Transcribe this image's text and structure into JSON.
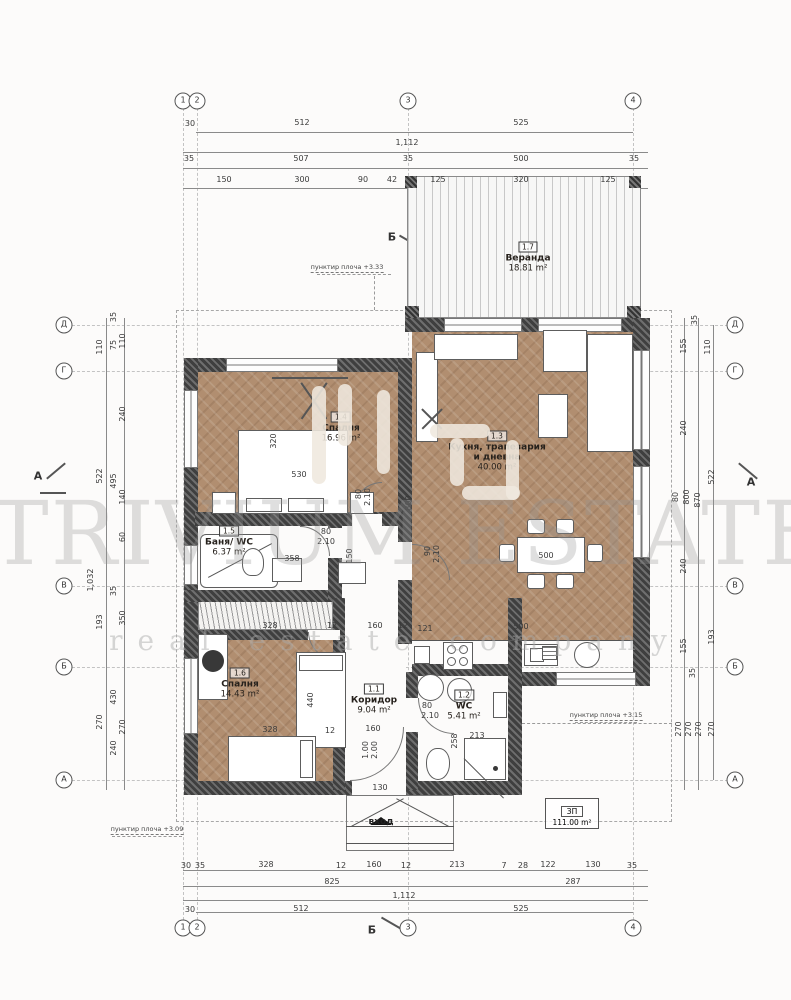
{
  "watermark": {
    "line1": "TRIVIUM ESTATE",
    "line2": "real estate company"
  },
  "entry": {
    "label": "вход"
  },
  "zp": {
    "label": "ЗП",
    "area": "111.00 m²"
  },
  "colors": {
    "floor_brown": "#b18e70",
    "wall_dark": "#4b4b4b",
    "line": "#8a8a8a"
  },
  "rooms": [
    {
      "id": "1.7",
      "name": "Веранда",
      "area": "18.81 m²",
      "x": 528,
      "y": 254
    },
    {
      "id": "1.3",
      "name": "Кухня, трапезария",
      "name2": "и дневна",
      "area": "40.00 m²",
      "x": 497,
      "y": 448
    },
    {
      "id": "1.4",
      "name": "Спалня",
      "area": "16.96 m²",
      "x": 341,
      "y": 424
    },
    {
      "id": "1.5",
      "name": "Баня/ WC",
      "area": "6.37 m²",
      "x": 229,
      "y": 538
    },
    {
      "id": "1.6",
      "name": "Спалня",
      "area": "14.43 m²",
      "x": 240,
      "y": 680
    },
    {
      "id": "1.1",
      "name": "Коридор",
      "area": "9.04 m²",
      "x": 374,
      "y": 696
    },
    {
      "id": "1.2",
      "name": "WC",
      "area": "5.41 m²",
      "x": 464,
      "y": 702
    }
  ],
  "bubbles": [
    {
      "t": "1",
      "x": 183,
      "y": 101
    },
    {
      "t": "2",
      "x": 197,
      "y": 101
    },
    {
      "t": "3",
      "x": 408,
      "y": 101
    },
    {
      "t": "4",
      "x": 633,
      "y": 101
    },
    {
      "t": "1",
      "x": 183,
      "y": 928
    },
    {
      "t": "2",
      "x": 197,
      "y": 928
    },
    {
      "t": "3",
      "x": 408,
      "y": 928
    },
    {
      "t": "4",
      "x": 633,
      "y": 928
    },
    {
      "t": "Д",
      "x": 64,
      "y": 325
    },
    {
      "t": "Г",
      "x": 64,
      "y": 371
    },
    {
      "t": "В",
      "x": 64,
      "y": 586
    },
    {
      "t": "Б",
      "x": 64,
      "y": 667
    },
    {
      "t": "А",
      "x": 64,
      "y": 780
    },
    {
      "t": "Д",
      "x": 735,
      "y": 325
    },
    {
      "t": "Г",
      "x": 735,
      "y": 371
    },
    {
      "t": "В",
      "x": 735,
      "y": 586
    },
    {
      "t": "Б",
      "x": 735,
      "y": 667
    },
    {
      "t": "А",
      "x": 735,
      "y": 780
    }
  ],
  "markers": [
    {
      "t": "Б",
      "x": 392,
      "y": 237
    },
    {
      "t": "А",
      "x": 38,
      "y": 476
    },
    {
      "t": "А",
      "x": 751,
      "y": 482
    },
    {
      "t": "Б",
      "x": 372,
      "y": 930
    }
  ],
  "annotations": [
    {
      "t": "пунктир плоча +3.33",
      "x": 347,
      "y": 268
    },
    {
      "t": "пунктир плоча +3.15",
      "x": 606,
      "y": 716
    },
    {
      "t": "пунктир плоча +3.09",
      "x": 147,
      "y": 830
    }
  ],
  "dimensions": [
    {
      "t": "30",
      "x": 190,
      "y": 124
    },
    {
      "t": "512",
      "x": 302,
      "y": 123
    },
    {
      "t": "525",
      "x": 521,
      "y": 123
    },
    {
      "t": "1,112",
      "x": 407,
      "y": 143
    },
    {
      "t": "35",
      "x": 189,
      "y": 159
    },
    {
      "t": "507",
      "x": 301,
      "y": 159
    },
    {
      "t": "35",
      "x": 408,
      "y": 159
    },
    {
      "t": "500",
      "x": 521,
      "y": 159
    },
    {
      "t": "35",
      "x": 634,
      "y": 159
    },
    {
      "t": "150",
      "x": 224,
      "y": 180
    },
    {
      "t": "300",
      "x": 302,
      "y": 180
    },
    {
      "t": "90",
      "x": 363,
      "y": 180
    },
    {
      "t": "42",
      "x": 392,
      "y": 180
    },
    {
      "t": "125",
      "x": 438,
      "y": 180
    },
    {
      "t": "320",
      "x": 521,
      "y": 180
    },
    {
      "t": "125",
      "x": 608,
      "y": 180
    },
    {
      "t": "30",
      "x": 186,
      "y": 866
    },
    {
      "t": "35",
      "x": 200,
      "y": 866
    },
    {
      "t": "328",
      "x": 266,
      "y": 865
    },
    {
      "t": "12",
      "x": 341,
      "y": 866
    },
    {
      "t": "160",
      "x": 374,
      "y": 865
    },
    {
      "t": "12",
      "x": 406,
      "y": 866
    },
    {
      "t": "213",
      "x": 457,
      "y": 865
    },
    {
      "t": "7",
      "x": 504,
      "y": 866
    },
    {
      "t": "28",
      "x": 523,
      "y": 866
    },
    {
      "t": "122",
      "x": 548,
      "y": 865
    },
    {
      "t": "130",
      "x": 593,
      "y": 865
    },
    {
      "t": "35",
      "x": 632,
      "y": 866
    },
    {
      "t": "825",
      "x": 332,
      "y": 882
    },
    {
      "t": "287",
      "x": 573,
      "y": 882
    },
    {
      "t": "1,112",
      "x": 404,
      "y": 896
    },
    {
      "t": "30",
      "x": 190,
      "y": 910
    },
    {
      "t": "512",
      "x": 301,
      "y": 909
    },
    {
      "t": "525",
      "x": 521,
      "y": 909
    },
    {
      "t": "110",
      "x": 100,
      "y": 347,
      "r": -90
    },
    {
      "t": "522",
      "x": 100,
      "y": 476,
      "r": -90
    },
    {
      "t": "193",
      "x": 100,
      "y": 622,
      "r": -90
    },
    {
      "t": "270",
      "x": 100,
      "y": 722,
      "r": -90
    },
    {
      "t": "35",
      "x": 114,
      "y": 317,
      "r": -90
    },
    {
      "t": "110",
      "x": 123,
      "y": 341,
      "r": -90
    },
    {
      "t": "75",
      "x": 114,
      "y": 345,
      "r": -90
    },
    {
      "t": "240",
      "x": 123,
      "y": 414,
      "r": -90
    },
    {
      "t": "495",
      "x": 114,
      "y": 481,
      "r": -90
    },
    {
      "t": "140",
      "x": 123,
      "y": 497,
      "r": -90
    },
    {
      "t": "60",
      "x": 123,
      "y": 537,
      "r": -90
    },
    {
      "t": "1,032",
      "x": 91,
      "y": 580,
      "r": -90
    },
    {
      "t": "35",
      "x": 114,
      "y": 591,
      "r": -90
    },
    {
      "t": "350",
      "x": 123,
      "y": 618,
      "r": -90
    },
    {
      "t": "430",
      "x": 114,
      "y": 697,
      "r": -90
    },
    {
      "t": "270",
      "x": 123,
      "y": 727,
      "r": -90
    },
    {
      "t": "240",
      "x": 114,
      "y": 748,
      "r": -90
    },
    {
      "t": "35",
      "x": 695,
      "y": 320,
      "r": -90
    },
    {
      "t": "155",
      "x": 684,
      "y": 346,
      "r": -90
    },
    {
      "t": "110",
      "x": 708,
      "y": 347,
      "r": -90
    },
    {
      "t": "240",
      "x": 684,
      "y": 428,
      "r": -90
    },
    {
      "t": "80",
      "x": 676,
      "y": 497,
      "r": -90
    },
    {
      "t": "800",
      "x": 687,
      "y": 497,
      "r": -90
    },
    {
      "t": "870",
      "x": 698,
      "y": 500,
      "r": -90
    },
    {
      "t": "522",
      "x": 712,
      "y": 477,
      "r": -90
    },
    {
      "t": "240",
      "x": 684,
      "y": 566,
      "r": -90
    },
    {
      "t": "155",
      "x": 684,
      "y": 646,
      "r": -90
    },
    {
      "t": "35",
      "x": 693,
      "y": 673,
      "r": -90
    },
    {
      "t": "193",
      "x": 712,
      "y": 637,
      "r": -90
    },
    {
      "t": "270",
      "x": 679,
      "y": 729,
      "r": -90
    },
    {
      "t": "270",
      "x": 689,
      "y": 729,
      "r": -90
    },
    {
      "t": "270",
      "x": 699,
      "y": 729,
      "r": -90
    },
    {
      "t": "270",
      "x": 712,
      "y": 729,
      "r": -90
    },
    {
      "t": "320",
      "x": 274,
      "y": 441,
      "r": -90
    },
    {
      "t": "530",
      "x": 299,
      "y": 475
    },
    {
      "t": "150",
      "x": 350,
      "y": 556,
      "r": -90
    },
    {
      "t": "358",
      "x": 292,
      "y": 559
    },
    {
      "t": "80",
      "x": 326,
      "y": 532
    },
    {
      "t": "2.10",
      "x": 326,
      "y": 542
    },
    {
      "t": "80",
      "x": 359,
      "y": 494,
      "r": -90
    },
    {
      "t": "2.10",
      "x": 368,
      "y": 497,
      "r": -90
    },
    {
      "t": "90",
      "x": 428,
      "y": 551,
      "r": -90
    },
    {
      "t": "2.10",
      "x": 437,
      "y": 554,
      "r": -90
    },
    {
      "t": "800",
      "x": 409,
      "y": 503,
      "r": -90
    },
    {
      "t": "500",
      "x": 546,
      "y": 556
    },
    {
      "t": "500",
      "x": 521,
      "y": 627
    },
    {
      "t": "328",
      "x": 270,
      "y": 626
    },
    {
      "t": "12",
      "x": 332,
      "y": 626
    },
    {
      "t": "160",
      "x": 375,
      "y": 626
    },
    {
      "t": "12",
      "x": 403,
      "y": 626
    },
    {
      "t": "121",
      "x": 425,
      "y": 629
    },
    {
      "t": "328",
      "x": 270,
      "y": 730
    },
    {
      "t": "12",
      "x": 330,
      "y": 731
    },
    {
      "t": "160",
      "x": 373,
      "y": 729
    },
    {
      "t": "440",
      "x": 311,
      "y": 700,
      "r": -90
    },
    {
      "t": "80",
      "x": 427,
      "y": 706
    },
    {
      "t": "2.10",
      "x": 430,
      "y": 716
    },
    {
      "t": "213",
      "x": 477,
      "y": 736
    },
    {
      "t": "258",
      "x": 455,
      "y": 741,
      "r": -90
    },
    {
      "t": "1.00",
      "x": 366,
      "y": 750,
      "r": -90
    },
    {
      "t": "2.00",
      "x": 375,
      "y": 750,
      "r": -90
    },
    {
      "t": "130",
      "x": 380,
      "y": 788
    }
  ]
}
